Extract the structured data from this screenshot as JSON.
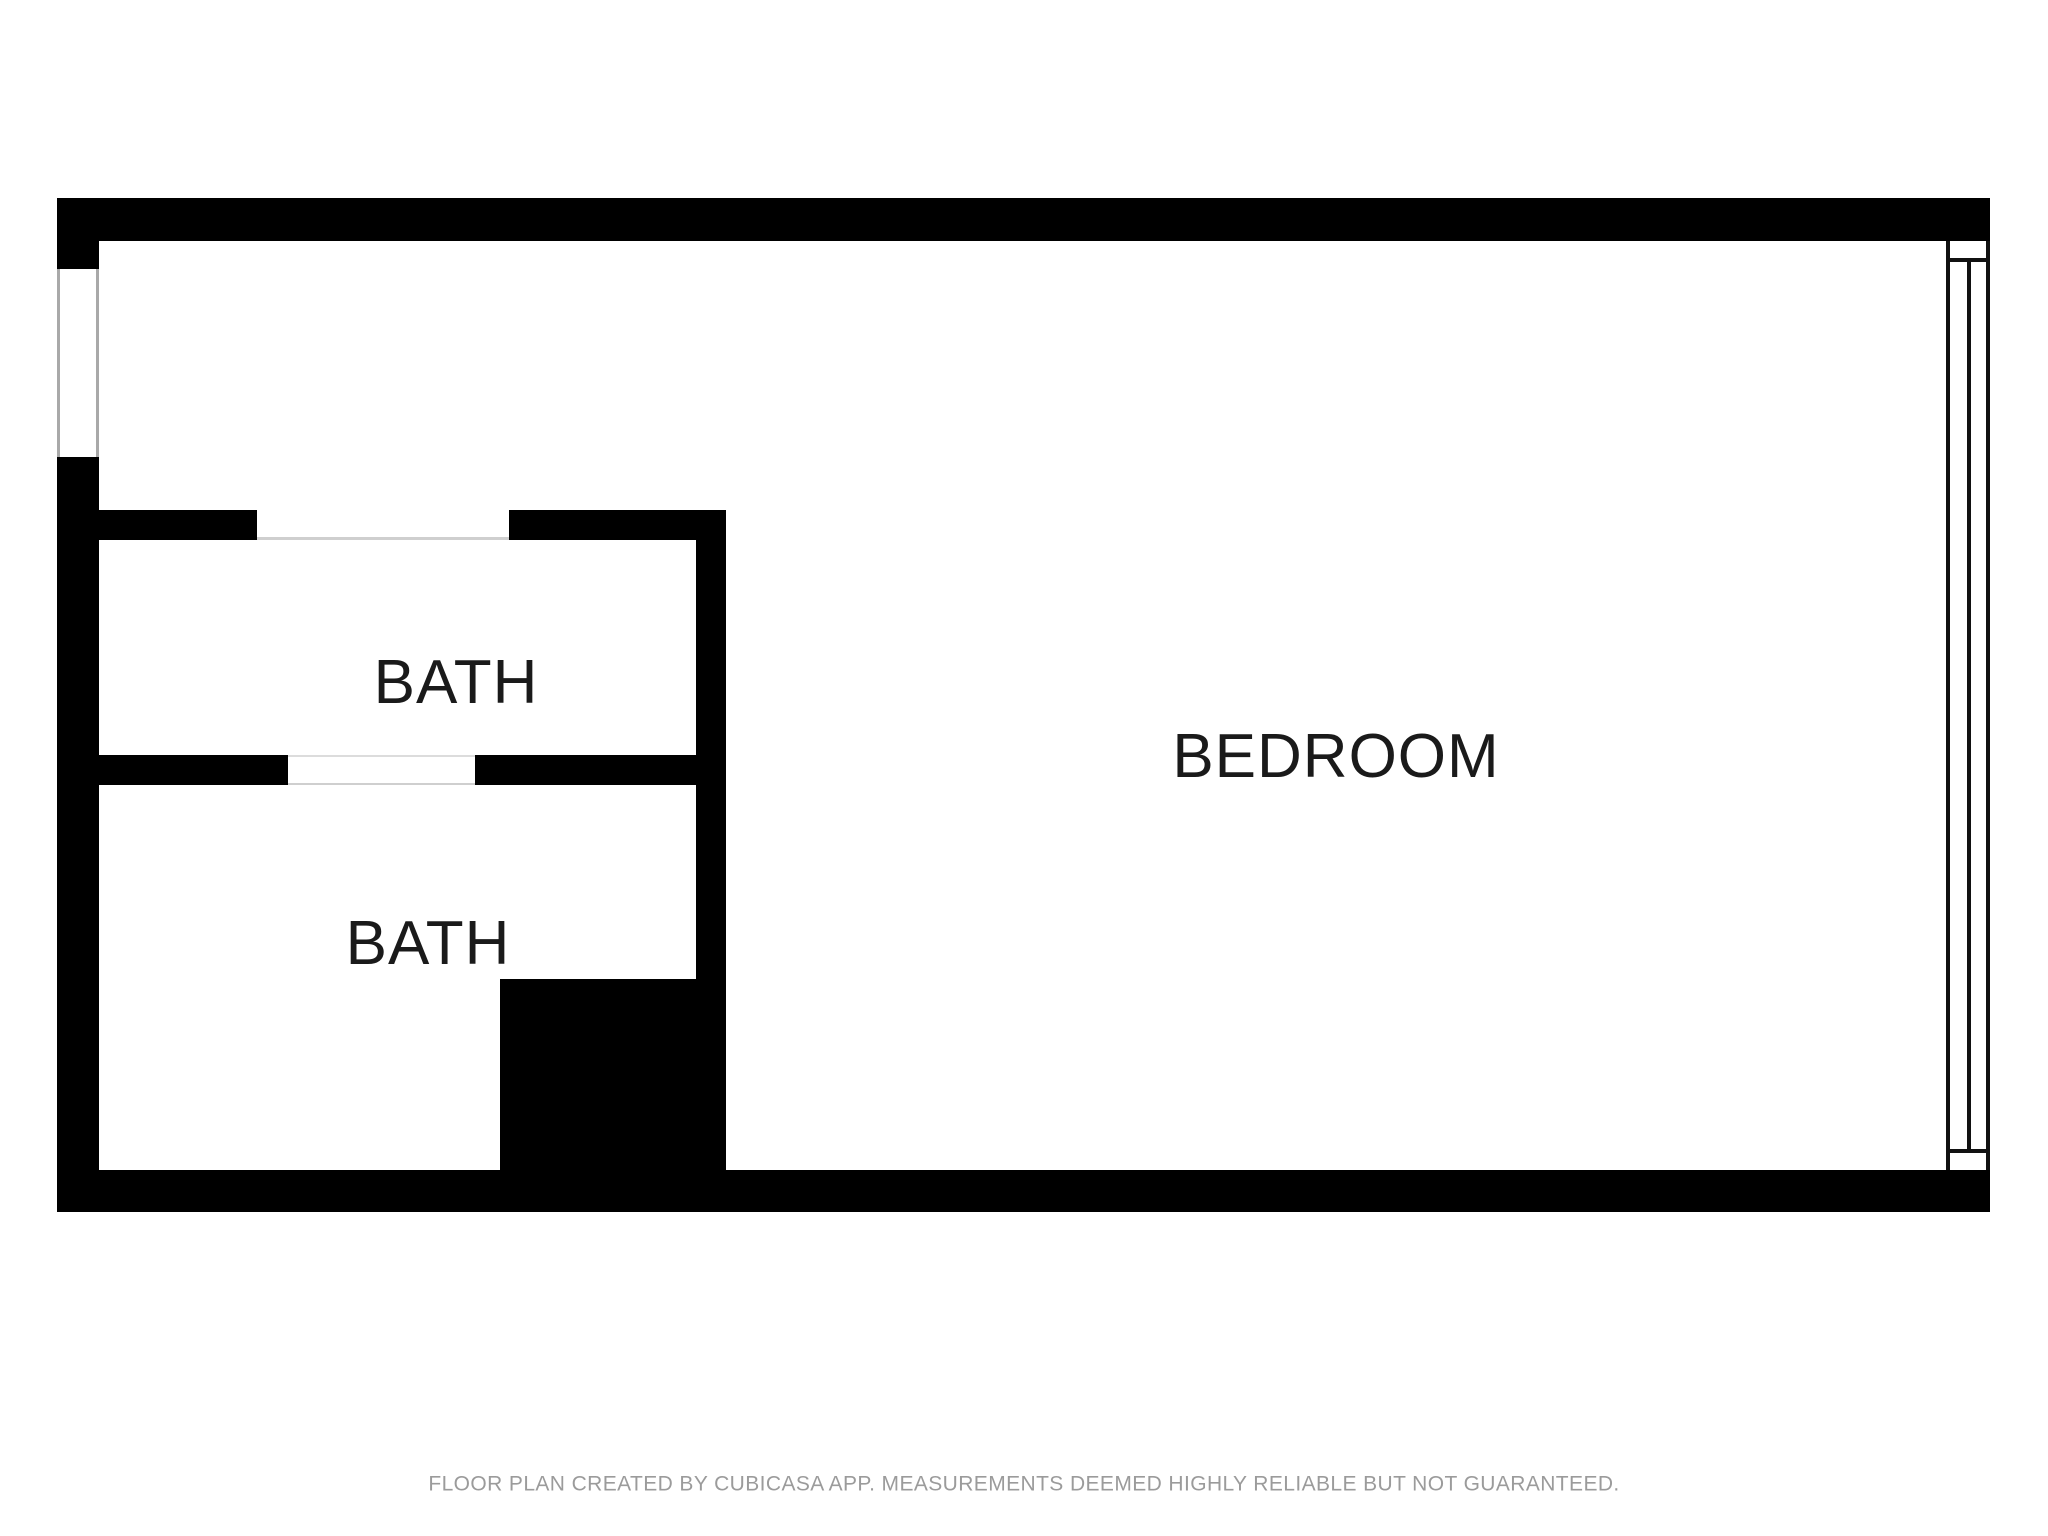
{
  "floor_plan": {
    "rooms": [
      {
        "id": "bath-1",
        "label": "BATH"
      },
      {
        "id": "bath-2",
        "label": "BATH"
      },
      {
        "id": "bedroom",
        "label": "BEDROOM"
      }
    ],
    "footer_disclaimer": "FLOOR PLAN CREATED BY CUBICASA APP. MEASUREMENTS DEEMED HIGHLY RELIABLE BUT NOT GUARANTEED.",
    "colors": {
      "wall": "#000000",
      "window_line": "#111111",
      "opening_line": "#cfcfcf",
      "label_text": "#1a1a1a",
      "footer_text": "#9b9b9b"
    }
  }
}
